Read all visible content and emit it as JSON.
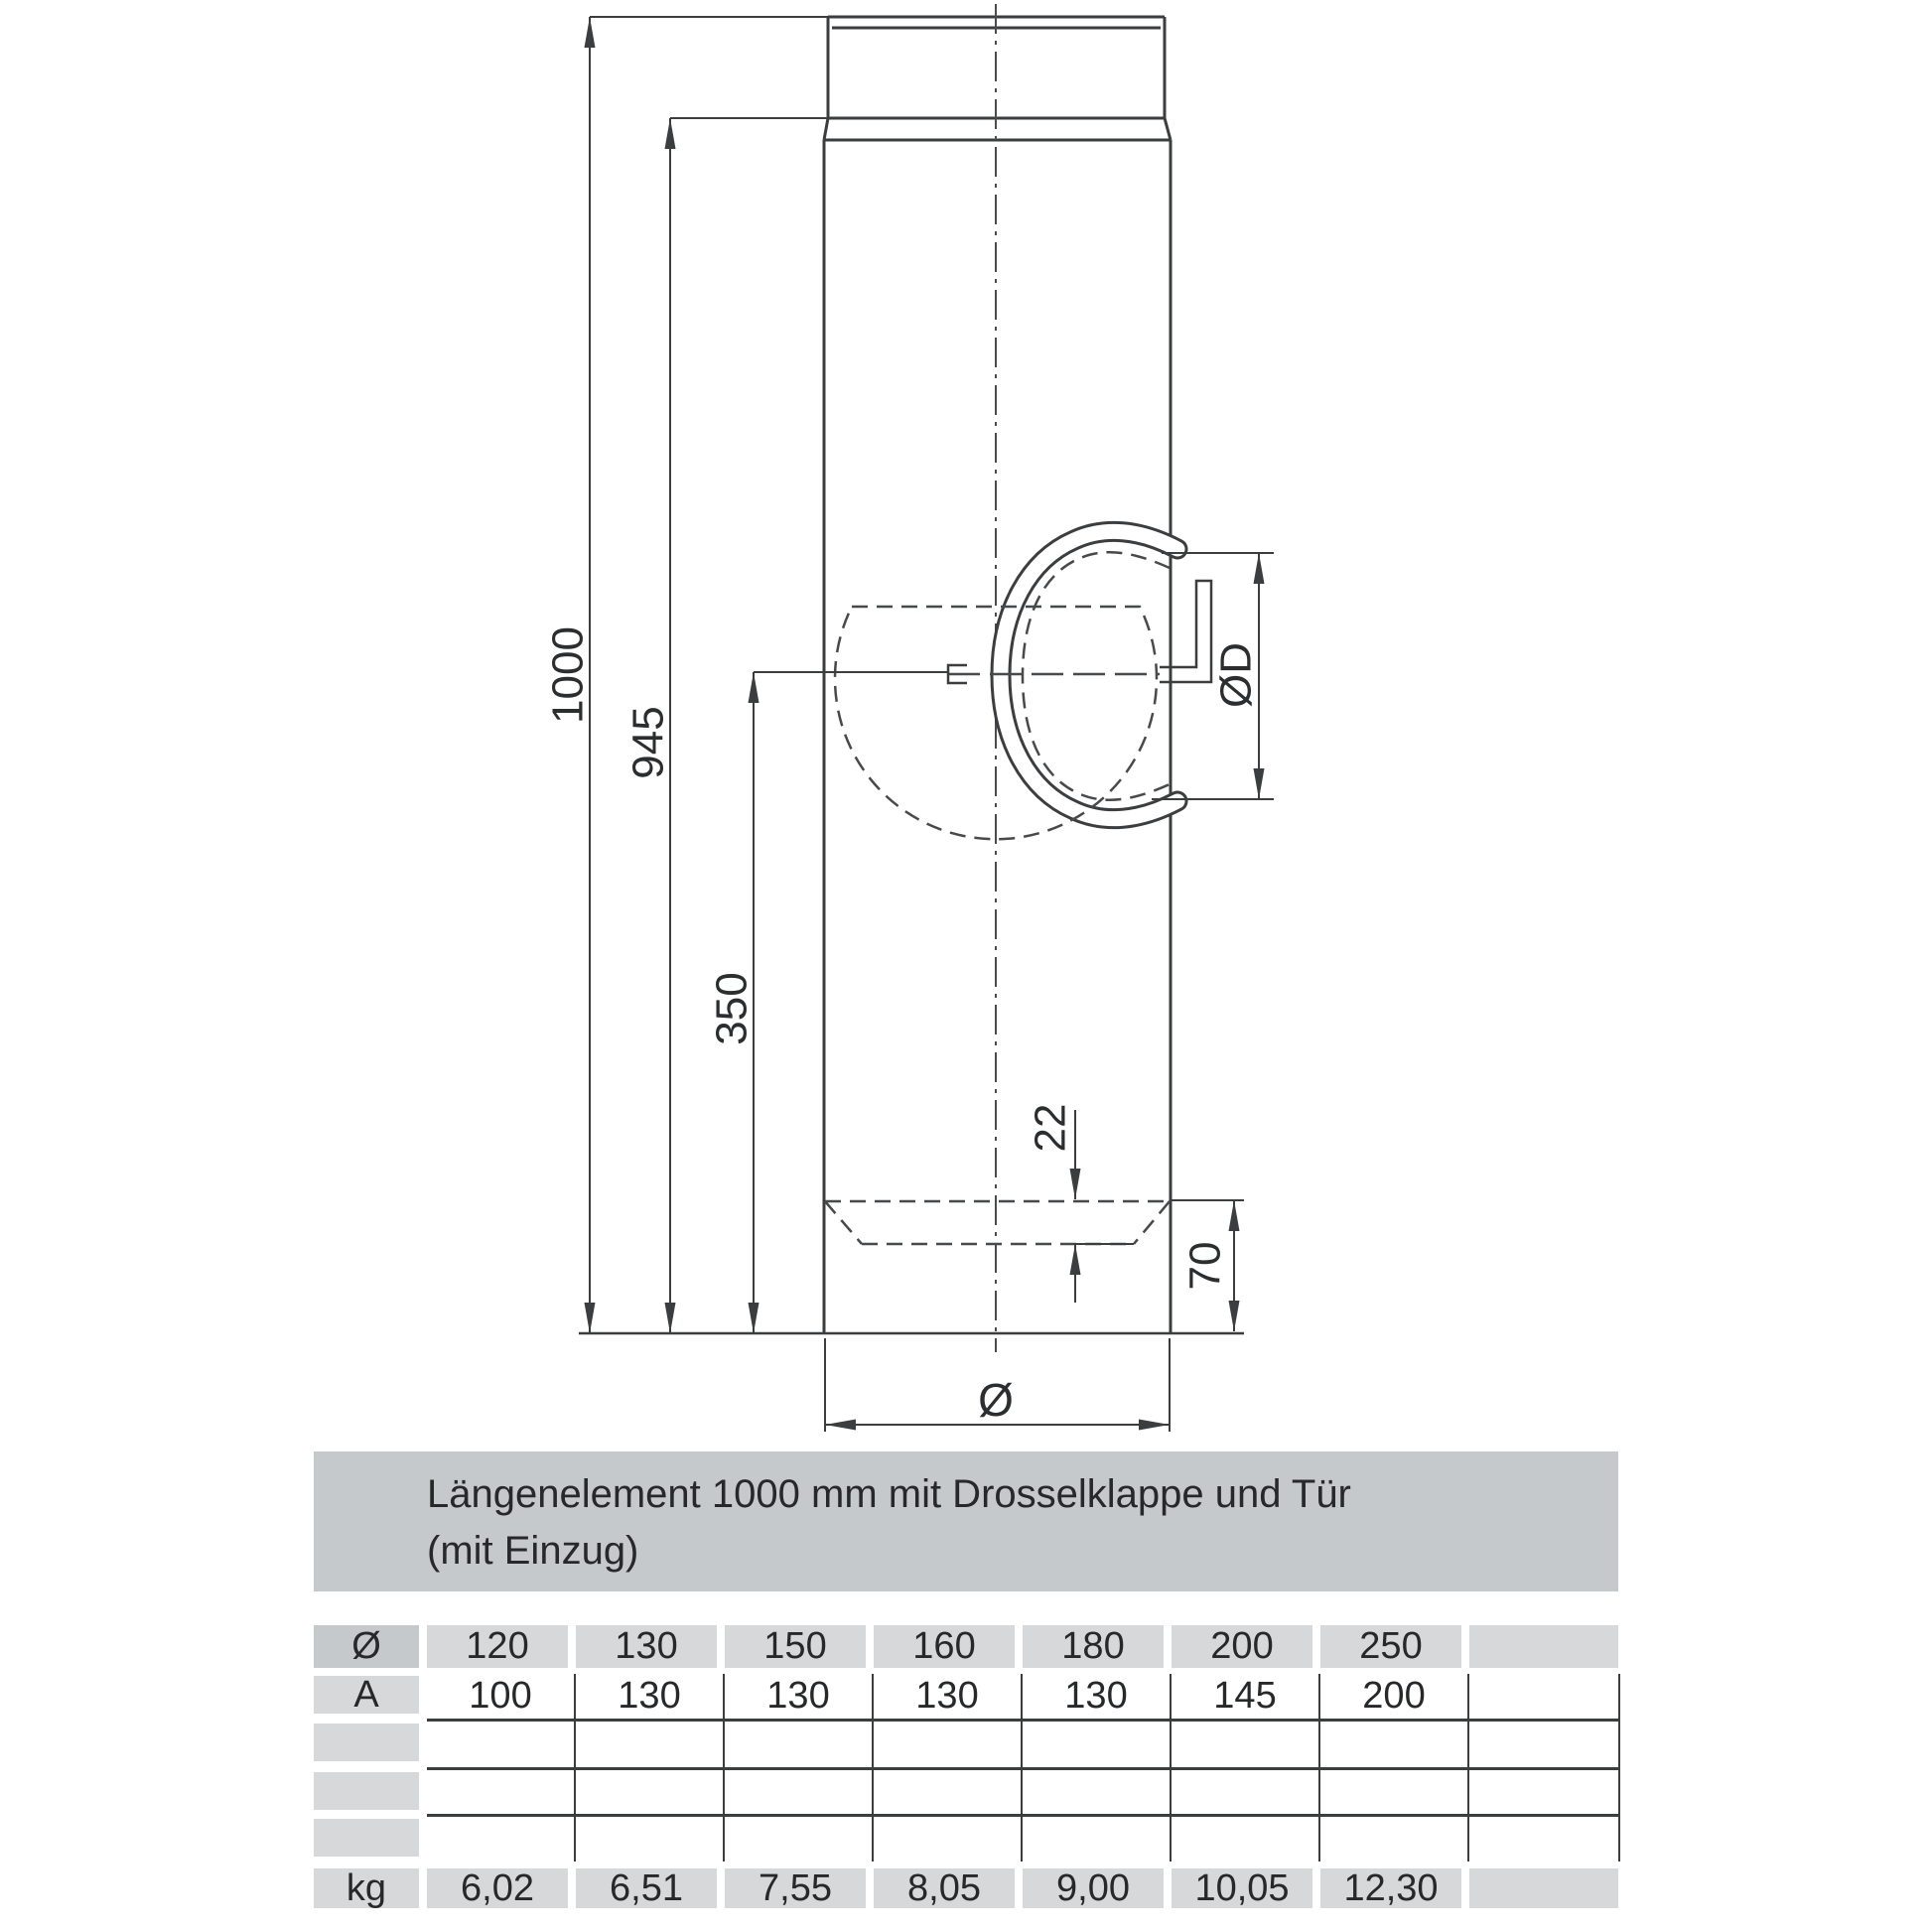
{
  "title": {
    "line1": "Längenelement 1000 mm mit Drosselklappe und Tür",
    "line2": "(mit Einzug)"
  },
  "drawing": {
    "description": "Technical drawing of a 1000 mm flue pipe length element with damper (Drosselklappe) and door (Tür), with dimension lines",
    "dims": {
      "total_length": "1000",
      "length_below_collar": "945",
      "damper_axis_height": "350",
      "door_inset": "22",
      "door_bottom_offset": "70",
      "pipe_diameter": "Ø",
      "damper_diameter": "ØD"
    }
  },
  "table": {
    "header": {
      "label": "Ø",
      "values": [
        "120",
        "130",
        "150",
        "160",
        "180",
        "200",
        "250",
        ""
      ]
    },
    "rows": [
      {
        "label": "A",
        "values": [
          "100",
          "130",
          "130",
          "130",
          "130",
          "145",
          "200",
          ""
        ]
      },
      {
        "label": "",
        "values": [
          "",
          "",
          "",
          "",
          "",
          "",
          "",
          ""
        ]
      },
      {
        "label": "",
        "values": [
          "",
          "",
          "",
          "",
          "",
          "",
          "",
          ""
        ]
      },
      {
        "label": "",
        "values": [
          "",
          "",
          "",
          "",
          "",
          "",
          "",
          ""
        ]
      }
    ],
    "footer": {
      "label": "kg",
      "values": [
        "6,02",
        "6,51",
        "7,55",
        "8,05",
        "9,00",
        "10,05",
        "12,30",
        ""
      ]
    }
  },
  "colors": {
    "title_box_bg": "#c6c9cb",
    "table_cell_bg": "#d6d8d9",
    "table_header_label_bg": "#c6c9cb",
    "drawing_line": "#3b3d3f",
    "text": "#26282a",
    "background": "#ffffff"
  }
}
